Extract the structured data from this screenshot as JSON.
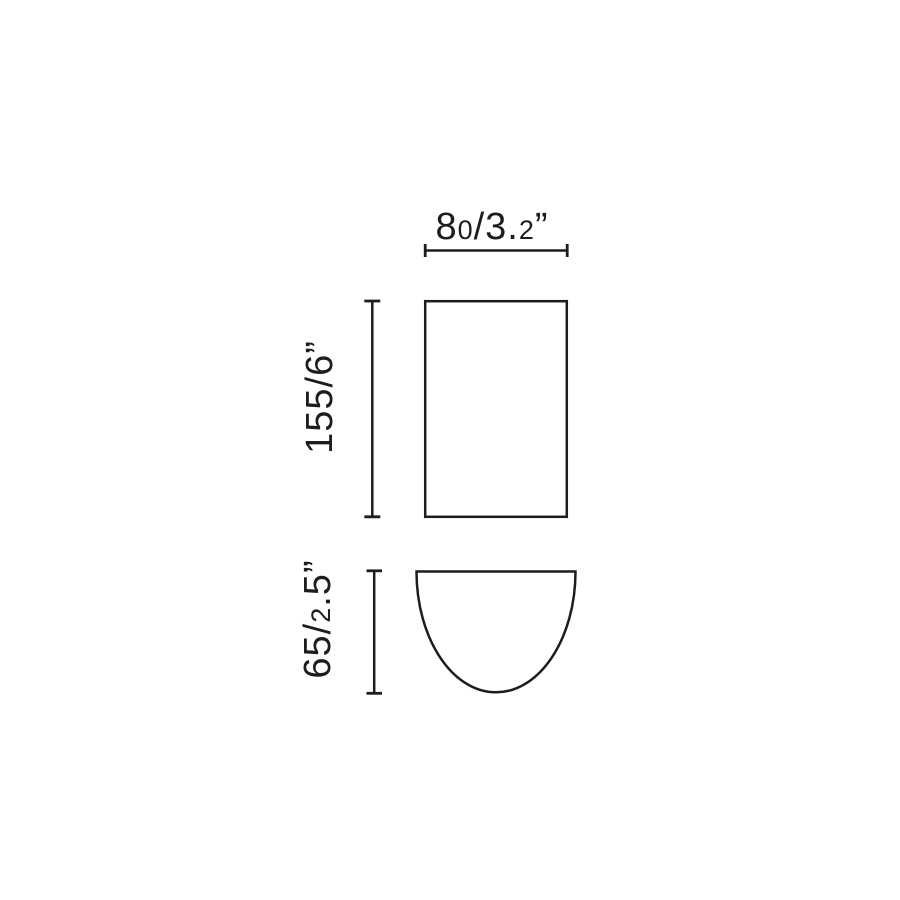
{
  "canvas": {
    "background": "#ffffff",
    "line_color": "#1d1d1b"
  },
  "dimensions": {
    "width": {
      "mm": "80",
      "inches": "3.2",
      "label": "80/3.2”",
      "parts": [
        {
          "t": "8"
        },
        {
          "t": "0",
          "small": true
        },
        {
          "t": "/3."
        },
        {
          "t": "2",
          "small": true
        },
        {
          "t": "”"
        }
      ]
    },
    "height": {
      "mm": "155",
      "inches": "6",
      "label": "155/6”",
      "parts": [
        {
          "t": "155/6"
        },
        {
          "t": "”"
        }
      ]
    },
    "depth": {
      "mm": "65",
      "inches": "2.5",
      "label": "65/2.5”",
      "parts": [
        {
          "t": "65/"
        },
        {
          "t": "2",
          "small": true
        },
        {
          "t": ".5"
        },
        {
          "t": "”"
        }
      ]
    }
  }
}
